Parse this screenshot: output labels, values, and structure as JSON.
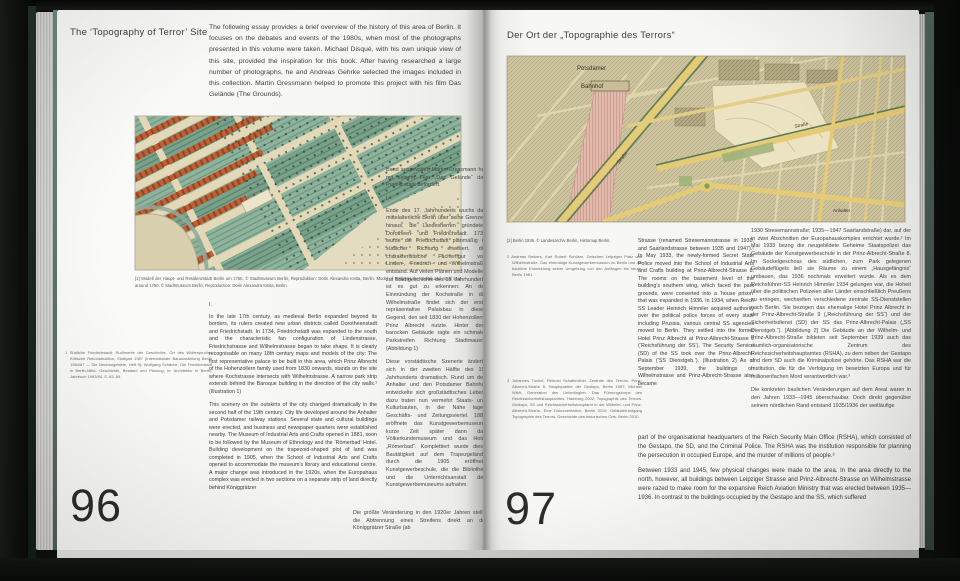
{
  "book": {
    "left_page": {
      "page_number": "96",
      "title": "The ‘Topography of Terror’ Site",
      "intro": "The following essay provides a brief overview of the history of this area of Berlin. It focuses on the debates and events of the 1980s, when most of the photographs presented in this volume were taken. Michael Disqué, with his own unique view of this site, provided the inspiration for this book. After having researched a large number of photographs, he and Andreas Gehrke selected the images included in this collection. Martin Gressmann helped to promote this project with his film Das Gelände (The Grounds).",
      "caption": "[1] Modell der Haupt- und Residenzstadt Berlin um 1750. © Stadtmuseum Berlin, Reproduktion: Dorin Alexandra Ionita, Berlin. Model of Berlin as the capital and royal seat around 1750. © Stadtmuseum Berlin, Reproduction: Dorin Alexandra Ionita, Berlin.",
      "footnote_1": "1  Südliche Friedrichstadt: Rudimente der Geschichte, Ort des Widerspruchs, Kritische Rekonstruktion, Stuttgart 1987 (Internationale Bauausstellung Berlin 1984/87 — Die Neubaugebiete, Heft 5); Wolfgang Schäche, Die Friedrichstadt in Berlin-Mitte. Geschichte, Bestand und Planung, in: Architektur in Berlin, Jahrbuch 1993/94, S. 63–69.",
      "section_marker_en": "I.",
      "english_paragraph_1": "In the late 17th century, as medieval Berlin expanded beyond its borders, its rulers created new urban districts called Dorotheenstadt and Friedrichstadt. In 1734, Friedrichstadt was expanded to the south and the characteristic fan configuration of Lindenstrasse, Friedrichstrasse and Wilhelmstrasse began to take shape. It is clearly recognisable on many 18th century maps and models of the city: The first representative palace to be built in this area, which Prinz Albrecht of the Hohenzollern family used from 1830 onwards, stands on the site where Kochstrasse intersects with Wilhelmstrasse. A narrow park strip extends behind the Baroque building in the direction of the city walls.¹ (Illustration 1)",
      "english_paragraph_2": "This scenery on the outskirts of the city changed dramatically in the second half of the 19th century. City life developed around the Anhalter and Potsdamer railway stations. Several state and cultural buildings were erected, and business and newspaper quarters were established nearby. The Museum of Industrial Arts and Crafts opened in 1881, soon to be followed by the Museum of Ethnology and the ‘Römerbad’ Hotel. Building development on the trapezoid-shaped plot of land was completed in 1905, when the School of Industrial Arts and Crafts opened to accommodate the museum’s library and educational centre. A major change was introduced in the 1920s, when the Europahaus complex was erected in two sections on a separate strip of land directly behind Königgrätzer",
      "german_carryover": "Band ausgewählt. Martin Gressmann hat mit seinem Film „Das Gelände“ das Projekt stark befördert.",
      "section_marker_de": "I.",
      "german_paragraph_1": "Ende des 17. Jahrhunderts wuchs das mittelalterliche Berlin über seine Grenzen hinaus, die Landesherren gründeten Dorotheen- und Friedrichstadt. 1734 wurde die Friedrichstadt planmäßig in südlicher Richtung erweitert, die charakteristische Fächerfigur von Linden-, Friedrich- und Wilhelmstraße entstand. Auf vielen Plänen und Modellen zur Stadtgeschichte des 18. Jahrhunderts ist es gut zu erkennen: An der Einmündung der Kochstraße in die Wilhelmstraße findet sich der erste repräsentative Palaisbau in dieser Gegend, den seit 1830 der Hohenzollern-Prinz Albrecht nutzte. Hinter dem barocken Gebäude ragte ein schmaler Parkstreifen Richtung Stadtmauer.¹ (Abbildung 1)",
      "german_paragraph_2": "Diese vorstädtische Szenerie änderte sich in der zweiten Hälfte des 19. Jahrhunderts dramatisch. Rund um den Anhalter und den Potsdamer Bahnhof entwickelte sich großstädtisches Leben, dazu traten nun vermehrt Staats- und Kulturbauten, in der Nähe lagen Geschäfts- und Zeitungsviertel. 1881 eröffnete das Kunstgewerbemuseum, kurze Zeit später dann das Völkerkundemuseum und das Hotel „Römerbad“. Komplettiert wurde diese Bautätigkeit auf dem Trapezgelände durch die 1905 eröffnete Kunstgewerbeschule, die die Bibliothek und die Unterrichtsanstalt des Kunstgewerbemuseums aufnahm.",
      "german_bottom_wide": "Die größte Veränderung in den 1920er Jahren stellte die Abtrennung eines Streifens direkt an der Königgrätzer Straße (ab"
    },
    "right_page": {
      "page_number": "97",
      "title": "Der Ort der „Topographie des Terrors“",
      "caption": "[2] Berlin 1936. © Landesarchiv Berlin, Histomap Berlin.",
      "footnote_2": "2  Andreas Bekiers, Karl Robert Schütze, Zwischen Leipziger Platz und Wilhelmstraße. Das ehemalige Kunstgewerbemuseum zu Berlin und die bauliche Entwicklung seiner Umgebung von den Anfängen bis heute, Berlin 1981.",
      "footnote_3": "3  Johannes Tuchel, Reinold Schattenfroh, Zentrale des Terrors. Prinz-Albrecht-Straße 8: Hauptquartier der Gestapo, Berlin 1987; Michael Wildt, Generation des Unbedingten. Das Führungskorps des Reichssicherheitshauptamtes, Hamburg 2002; Topographie des Terrors. Gestapo, SS und Reichssicherheitshauptamt in der Wilhelm- und Prinz-Albrecht-Straße. Eine Dokumentation, Berlin 2010; Geländerundgang Topographie des Terrors. Geschichte des historischen Orts, Berlin 2010.",
      "english_column": "Strasse (renamed Stresemannstrasse in 1930, and Saarlandstrasse between 1935 and 1947).² In May 1933, the newly-formed Secret State Police moved into the School of Industrial Arts and Crafts building at Prinz-Albrecht-Strasse 8. The rooms on the basement level of the building’s southern wing, which faced the park grounds, were converted into a ‘house prison’ that was expanded in 1936. In 1934, when Reich SS Leader Heinrich Himmler acquired authority over the political police forces of every state including Prussia, various central SS agencies moved to Berlin. They settled into the former Hotel Prinz Albrecht at Prinz-Albrecht-Strasse 9 (‘Reichsführung der SS’). The Security Service (SD) of the SS took over the Prinz-Albrecht-Palais (‘SS Dienstgeb.’). (Illustration 2) As of September 1939, the buildings on Wilhelmstrasse and Prinz-Albrecht-Strasse also became",
      "english_bottom_wide_1": "part of the organisational headquarters of the Reich Security Main Office (RSHA), which consisted of the Gestapo, the SD, and the Criminal Police. The RSHA was the institution responsible for planning the persecution in occupied Europe, and the murder of millions of people.³",
      "english_bottom_wide_2": "Between 1933 and 1945, few physical changes were made to the area. In the area directly to the north, however, all buildings between Leipziger Strasse and Prinz-Albrecht-Strasse on Wilhelmstrasse were razed to make room for the expansive Reich Aviation Ministry that was erected between 1935—1936. In contrast to the buildings occupied by the Gestapo and the SS, which suffered",
      "german_column": "1930 Stresemannstraße; 1935—1947 Saarlandstraße) dar, auf der in zwei Abschnitten der Europahauskomplex errichtet wurde.² Im Mai 1933 bezog die neugebildete Geheime Staatspolizei das Gebäude der Kunstgewerbeschule in der Prinz-Albrecht-Straße 8. Im Sockelgeschoss des südlichen, zum Park gelegenen Gebäudeflügels ließ sie Räume zu einem „Hausgefängnis“ umbauen, das 1936 nochmals erweitert wurde. Als es dem Reichsführer-SS Heinrich Himmler 1934 gelungen war, die Hoheit über die politischen Polizeien aller Länder einschließlich Preußens zu erringen, wechselten verschiedene zentrale SS-Dienststellen nach Berlin. Sie bezogen das ehemalige Hotel Prinz Albrecht in der Prinz-Albrecht-Straße 9 („Reichsführung der SS“) und der Sicherheitsdienst (SD) der SS das Prinz-Albrecht-Palais („SS Dienstgeb.“). [Abbildung 2] Die Gebäude an der Wilhelm- und Prinz-Albrecht-Straße bildeten seit September 1939 auch das räumlich-organisatorische Zentrum des Reichssicherheitshauptamtes (RSHA), zu dem neben der Gestapo und dem SD auch die Kriminalpolizei gehörte. Das RSHA war die Institution, die für die Verfolgung im besetzten Europa und für millionenfachen Mord verantwortlich war.³",
      "german_column_last": "Die konkreten baulichen Veränderungen auf dem Areal waren in den Jahren 1933—1945 überschaubar. Doch direkt gegenüber seinem nördlichen Rand entstand 1935/1936 der weitläufige"
    }
  },
  "figures": {
    "map_1936_labels": {
      "potsdamer": "Potsdamer",
      "bahnhof": "Bahnhof",
      "strasse_a": "Straße",
      "strasse_b": "Straße",
      "anhalter": "Anhalter"
    }
  },
  "colors": {
    "page_paper": "#f6f6f3",
    "map_street_yellow": "#e6cb76",
    "map_rail_pink": "#e3b9ac",
    "map_park_green": "#5f7d4a",
    "model_garden_green": "#8fb49e",
    "cover_green": "#577066"
  }
}
